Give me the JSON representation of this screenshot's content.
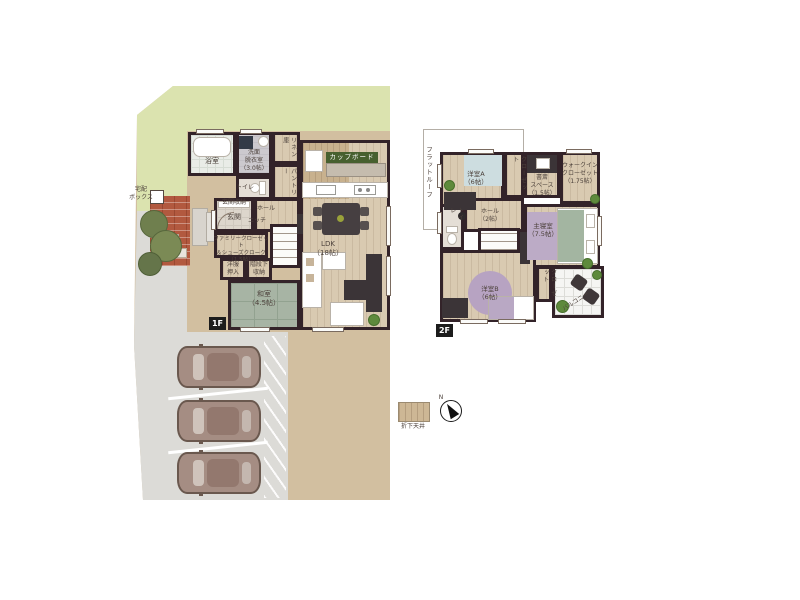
{
  "floor1": {
    "badge": "1F",
    "delivery_box": "宅配\nボックス",
    "rooms": {
      "bath": "浴室",
      "washroom": "洗面\n脱衣室\n（3.0帖）",
      "linen": "リネン庫",
      "pantry": "パントリー",
      "toilet": "トイレ",
      "entrance_storage": "玄関収納",
      "entrance": "玄関",
      "hall": "ホール",
      "niche": "ニッチ",
      "family_closet": "ファミリークローゼット\n＆シューズクローク\n（1.5帖）",
      "closet": "洋服\n押入",
      "under_stairs": "階段下\n収納",
      "tatami_room": "和室\n（4.5帖）",
      "ldk": "LDK\n（18帖）",
      "cupboard": "カップボード"
    }
  },
  "floor2": {
    "badge": "2F",
    "flat_roof": "フラットルーフ",
    "rooms": {
      "bedroom_a": "洋室A\n（6帖）",
      "closet_a": "クローゼット",
      "study": "書斎\nスペース\n（1.5帖）",
      "wic": "ウォークイン\nクローゼット\n（1.75帖）",
      "toilet": "トイレ",
      "hall": "ホール\n（2帖）",
      "master_bedroom": "主寝室\n（7.5帖）",
      "bedroom_b": "洋室B\n（6帖）",
      "closet_b": "クローゼット",
      "balcony": "バルコニー"
    }
  },
  "legend": {
    "dropped_ceiling": "折下天井",
    "compass_north": "N"
  },
  "colors": {
    "wall": "#332329",
    "wood_floor": "#d9cab1",
    "tatami": "#a7b4a4",
    "grass": "#dbe3af",
    "ground": "#d2bfa0",
    "driveway": "#dcdbd7",
    "brick": "#b2593f",
    "cupboard_badge": "#47602f",
    "badge_bg": "#1c1c1c"
  }
}
